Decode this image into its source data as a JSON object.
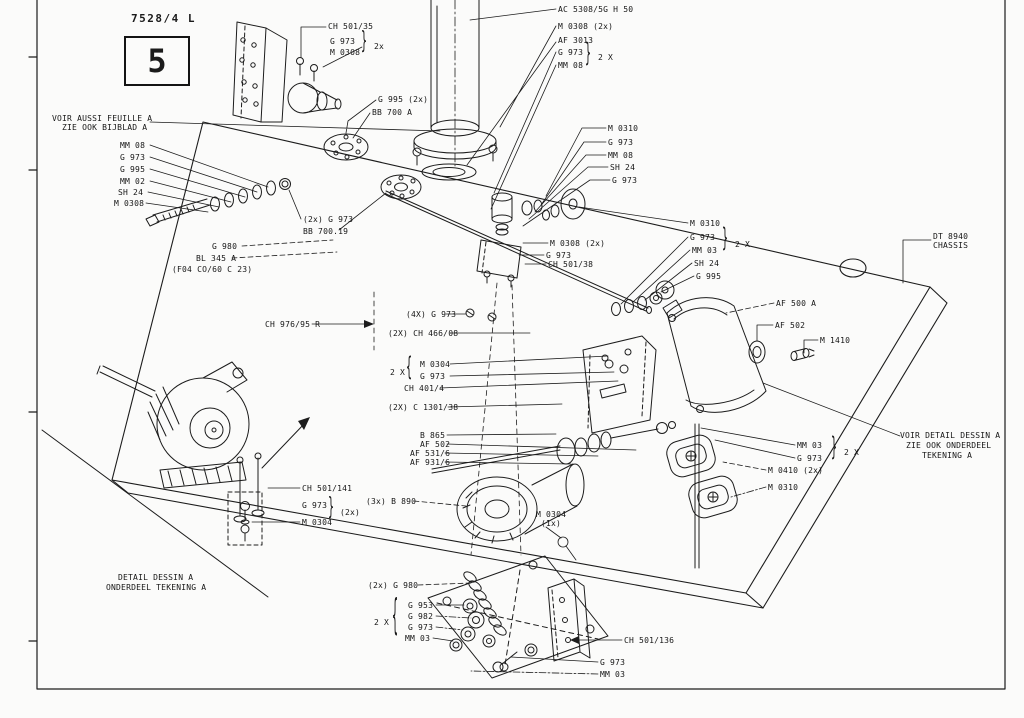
{
  "meta": {
    "drawing_number": "7528/4 L",
    "sheet_number": "5"
  },
  "glyphs": {
    "rbrace": "}",
    "lbrace": "{"
  },
  "notes": {
    "see_also_line1": "VOIR AUSSI FEUILLE A",
    "see_also_line2": "ZIE OOK BIJBLAD A",
    "chassis_line1": "DT 8940",
    "chassis_line2": "CHASSIS",
    "see_detail_line1": "VOIR DETAIL DESSIN A",
    "see_detail_line2": "ZIE OOK ONDERDEEL",
    "see_detail_line3": "TEKENING A",
    "detail_caption_line1": "DETAIL DESSIN A",
    "detail_caption_line2": "ONDERDEEL TEKENING A"
  },
  "callouts": [
    {
      "id": "ch501-35",
      "text": "CH 501/35"
    },
    {
      "id": "g973-tl",
      "text": "G 973"
    },
    {
      "id": "m0308-tl",
      "text": "M 0308"
    },
    {
      "id": "qty-tl",
      "text": "2x"
    },
    {
      "id": "ac5308",
      "text": "AC 5308/5G H 50"
    },
    {
      "id": "m0308-top",
      "text": "M 0308 (2x)"
    },
    {
      "id": "af3013",
      "text": "AF 3013"
    },
    {
      "id": "g973-top",
      "text": "G 973"
    },
    {
      "id": "mm08-top",
      "text": "MM 08"
    },
    {
      "id": "qty-top",
      "text": "2 X"
    },
    {
      "id": "g995-disc",
      "text": "G 995 (2x)"
    },
    {
      "id": "bb700a",
      "text": "BB 700 A"
    },
    {
      "id": "m0310-r1",
      "text": "M 0310"
    },
    {
      "id": "g973-r1",
      "text": "G 973"
    },
    {
      "id": "mm08-r1",
      "text": "MM 08"
    },
    {
      "id": "sh24-r1",
      "text": "SH 24"
    },
    {
      "id": "g973-r1b",
      "text": "G 973"
    },
    {
      "id": "m0310-mid",
      "text": "M 0310"
    },
    {
      "id": "g973-mid",
      "text": "G 973"
    },
    {
      "id": "mm03-mid",
      "text": "MM 03"
    },
    {
      "id": "sh24-mid",
      "text": "SH 24"
    },
    {
      "id": "g995-mid",
      "text": "G 995"
    },
    {
      "id": "qty-mid",
      "text": "2 X"
    },
    {
      "id": "m0308-valve",
      "text": "M 0308 (2x)"
    },
    {
      "id": "g973-valve",
      "text": "G 973"
    },
    {
      "id": "ch501-38",
      "text": "CH 501/38"
    },
    {
      "id": "mm08-l",
      "text": "MM 08"
    },
    {
      "id": "g973-l",
      "text": "G 973"
    },
    {
      "id": "g995-l",
      "text": "G 995"
    },
    {
      "id": "mm02-l",
      "text": "MM 02"
    },
    {
      "id": "sh24-l",
      "text": "SH 24"
    },
    {
      "id": "m0308-l",
      "text": "M 0308"
    },
    {
      "id": "g973-2x",
      "text": "(2x) G 973"
    },
    {
      "id": "bb700-19",
      "text": "BB 700.19"
    },
    {
      "id": "g980",
      "text": "G 980"
    },
    {
      "id": "bl345a",
      "text": "BL 345 A"
    },
    {
      "id": "f04",
      "text": "(F04 CO/60 C 23)"
    },
    {
      "id": "ch976-95r",
      "text": "CH 976/95 R"
    },
    {
      "id": "g973-4x",
      "text": "(4X) G 973"
    },
    {
      "id": "ch466-08",
      "text": "(2X) CH 466/08"
    },
    {
      "id": "qty-m0304",
      "text": "2 X"
    },
    {
      "id": "m0304-mid",
      "text": "M 0304"
    },
    {
      "id": "g973-m",
      "text": "G 973"
    },
    {
      "id": "ch401-4",
      "text": "CH 401/4"
    },
    {
      "id": "c1301-38",
      "text": "(2X) C 1301/38"
    },
    {
      "id": "b865",
      "text": "B 865"
    },
    {
      "id": "af502-c",
      "text": "AF 502"
    },
    {
      "id": "af531-6",
      "text": "AF 531/6"
    },
    {
      "id": "af931-6",
      "text": "AF 931/6"
    },
    {
      "id": "b890-3x",
      "text": "(3x) B 890"
    },
    {
      "id": "m0304-1x",
      "text": "M 0304"
    },
    {
      "id": "m0304-1xq",
      "text": "(1x)"
    },
    {
      "id": "af500a",
      "text": "AF 500 A"
    },
    {
      "id": "af502-r",
      "text": "AF 502"
    },
    {
      "id": "m1410",
      "text": "M 1410"
    },
    {
      "id": "mm03-r",
      "text": "MM 03"
    },
    {
      "id": "g973-r2",
      "text": "G 973"
    },
    {
      "id": "qty-r",
      "text": "2 X"
    },
    {
      "id": "m0410-2x",
      "text": "M 0410 (2x)"
    },
    {
      "id": "m0310-r2",
      "text": "M 0310"
    },
    {
      "id": "ch501-141",
      "text": "CH 501/141"
    },
    {
      "id": "g973-det",
      "text": "G 973"
    },
    {
      "id": "qty-det",
      "text": "(2x)"
    },
    {
      "id": "m0304-det",
      "text": "M 0304"
    },
    {
      "id": "g980-2x",
      "text": "(2x) G 980"
    },
    {
      "id": "g953",
      "text": "G 953"
    },
    {
      "id": "g982",
      "text": "G 982"
    },
    {
      "id": "g973-b",
      "text": "G 973"
    },
    {
      "id": "mm03-b",
      "text": "MM 03"
    },
    {
      "id": "qty-b",
      "text": "2 X"
    },
    {
      "id": "ch501-136",
      "text": "CH 501/136"
    },
    {
      "id": "g973-b2",
      "text": "G 973"
    },
    {
      "id": "mm03-b2",
      "text": "MM 03"
    }
  ]
}
